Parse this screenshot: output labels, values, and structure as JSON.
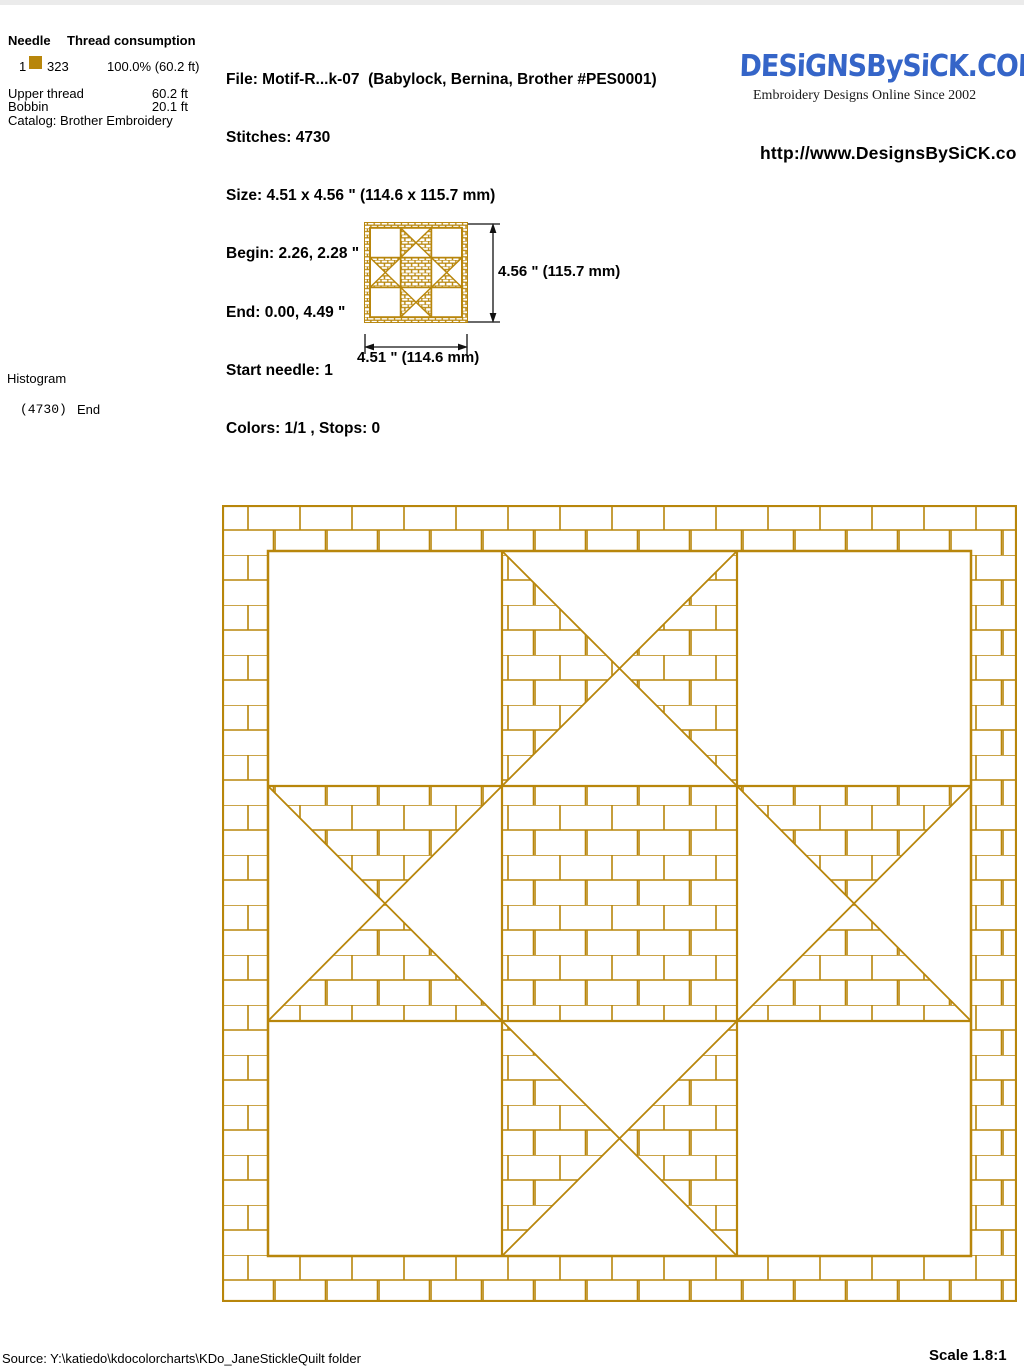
{
  "needle_table": {
    "header": {
      "needle": "Needle",
      "thread": "Thread consumption"
    },
    "row": {
      "needle": "1",
      "swatch_color": "#B8860B",
      "code": "323",
      "consumption": "100.0% (60.2 ft)"
    },
    "upper_thread_label": "Upper thread",
    "upper_thread_value": "60.2 ft",
    "bobbin_label": "Bobbin",
    "bobbin_value": "20.1 ft",
    "catalog": "Catalog: Brother Embroidery"
  },
  "file_info": {
    "lines": [
      "File: Motif-R...k-07  (Babylock, Bernina, Brother #PES0001)",
      "Stitches: 4730",
      "Size: 4.51 x 4.56 \" (114.6 x 115.7 mm)",
      "Begin: 2.26, 2.28 \"",
      "End: 0.00, 4.49 \"",
      "Start needle: 1",
      "Colors: 1/1 , Stops: 0"
    ]
  },
  "brand": {
    "logo": "DESiGNSBySiCK.COM",
    "logo_color": "#3565C8",
    "tagline": "Embroidery Designs Online Since 2002",
    "url": "http://www.DesignsBySiCK.co"
  },
  "preview": {
    "height_label": "4.56 \" (115.7 mm)",
    "width_label": "4.51 \" (114.6 mm)"
  },
  "histogram": {
    "title": "Histogram",
    "count": "(4730)",
    "end_label": "End"
  },
  "design": {
    "color": "#B8860B",
    "block": "ohio-star-quilt-block",
    "grid": "3x3",
    "border_fill": "brick",
    "center_cell": "brick-filled-square",
    "edge_cells": "hourglass-triangles-brick-filled",
    "corner_cells": "empty"
  },
  "footer": {
    "source": "Source: Y:\\katiedo\\kdocolorcharts\\KDo_JaneStickleQuilt folder",
    "scale": "Scale 1.8:1"
  }
}
